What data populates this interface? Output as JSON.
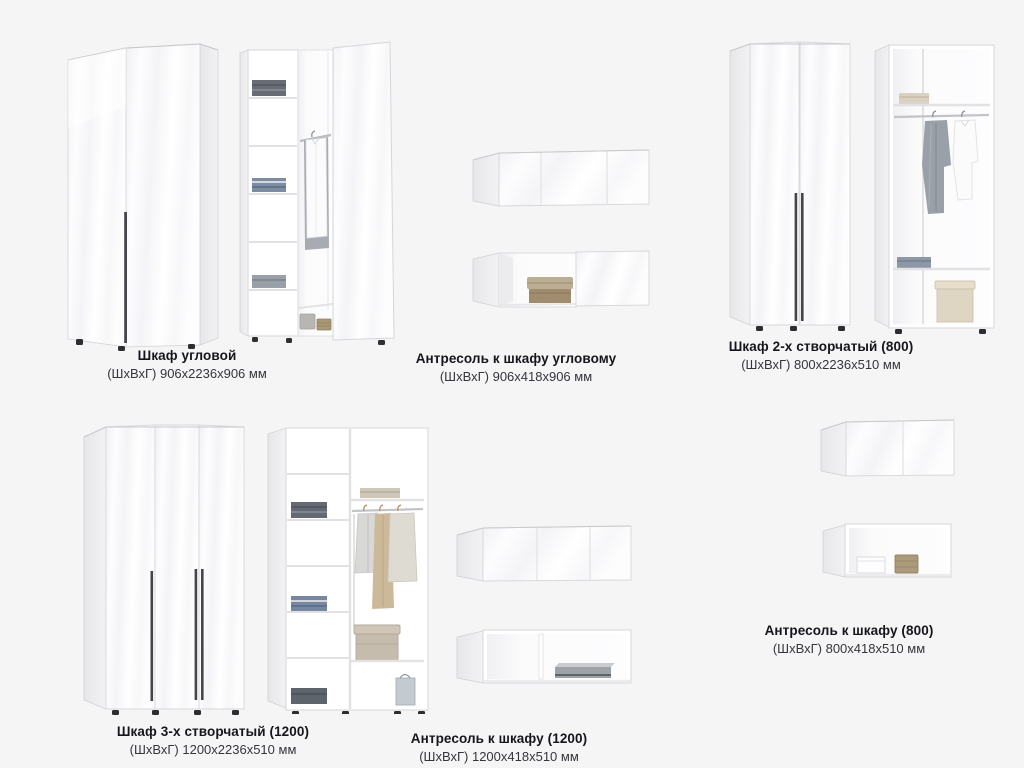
{
  "page": {
    "background": "#f5f5f6",
    "type": "furniture-catalog-sheet"
  },
  "colors": {
    "title_text": "#15151c",
    "dims_text": "#35353c",
    "panel_white": "#ffffff",
    "panel_side": "#ebebee",
    "outline": "#d6d6da",
    "handle": "#45454b",
    "chrome_rod": "#c2c4c8",
    "denim": "#7b8ca3",
    "dark_knit": "#646973",
    "beige_box": "#ded5c2",
    "wicker": "#ab9a7c"
  },
  "products": [
    {
      "id": "corner-wardrobe",
      "title": "Шкаф угловой",
      "dims": "(ШхВхГ) 906х2236х906 мм",
      "views": "closed, open"
    },
    {
      "id": "corner-mezzanine",
      "title": "Антресоль к шкафу угловому",
      "dims": "(ШхВхГ) 906х418х906 мм",
      "views": "closed, open"
    },
    {
      "id": "wardrobe-2-door",
      "title": "Шкаф 2-х створчатый (800)",
      "dims": "(ШхВхГ) 800х2236х510 мм",
      "views": "closed, open"
    },
    {
      "id": "wardrobe-3-door",
      "title": "Шкаф 3-х створчатый (1200)",
      "dims": "(ШхВхГ) 1200х2236х510 мм",
      "views": "closed, open"
    },
    {
      "id": "mezzanine-1200",
      "title": "Антресоль к шкафу (1200)",
      "dims": "(ШхВхГ) 1200х418х510 мм",
      "views": "closed, open"
    },
    {
      "id": "mezzanine-800",
      "title": "Антресоль к шкафу (800)",
      "dims": "(ШхВхГ) 800х418х510 мм",
      "views": "closed, open"
    }
  ]
}
